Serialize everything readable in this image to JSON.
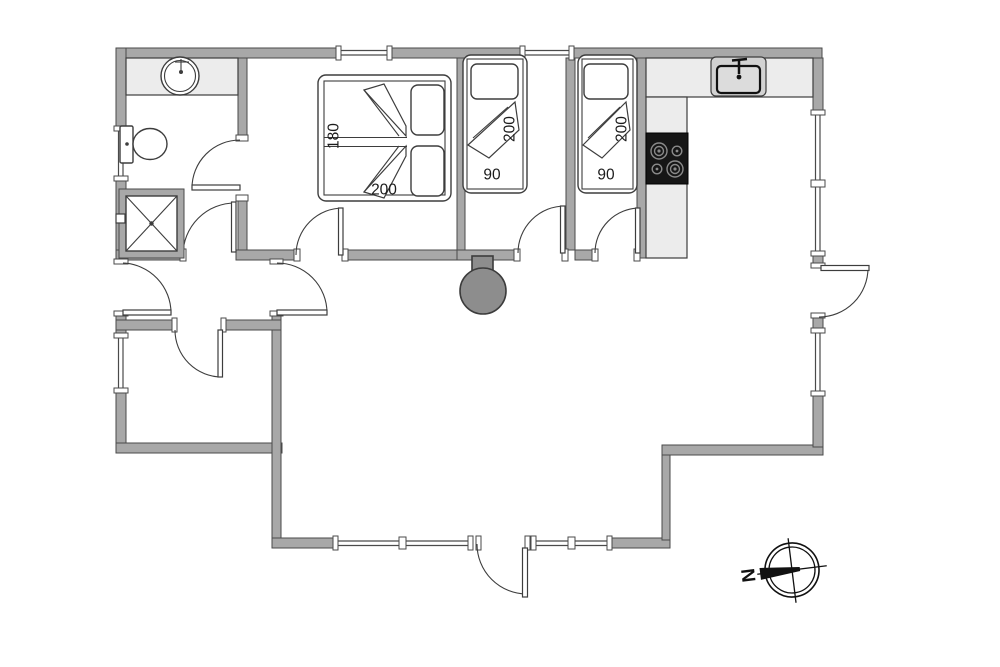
{
  "beds": {
    "double": {
      "width_label": "180",
      "length_label": "200"
    },
    "single_left": {
      "length_label": "200",
      "width_label": "90"
    },
    "single_right": {
      "length_label": "200",
      "width_label": "90"
    }
  },
  "compass": {
    "north_label": "N"
  },
  "colors": {
    "bg": "#ffffff",
    "wall": "#a8a8a8",
    "wall_stroke": "#4a4a4a",
    "fixture": "#ececec",
    "line": "#3d3d3d",
    "steel": "#d2d2d2",
    "stove": "#161616",
    "burner_ring": "#8a8a8a",
    "wood_stove": "#8d8d8d",
    "label": "#1c1c1c"
  }
}
